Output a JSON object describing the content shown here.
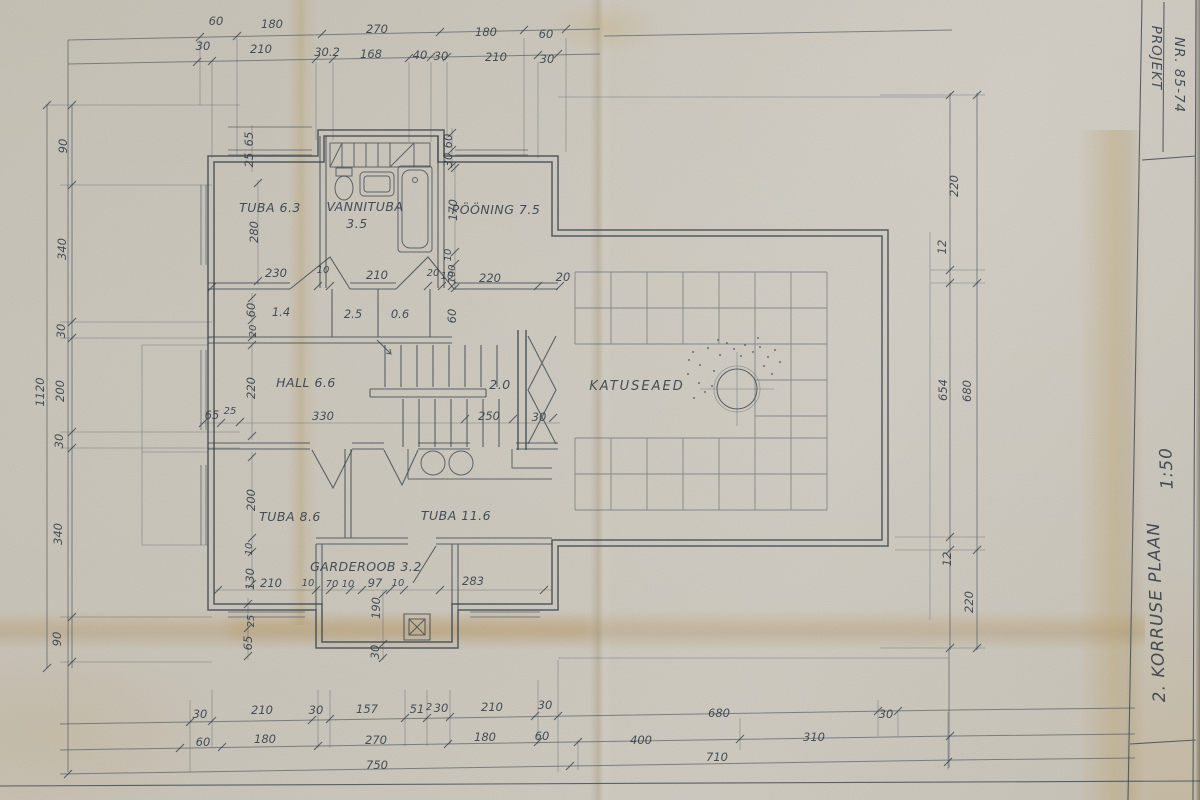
{
  "title_block": {
    "project_label": "PROJEKT",
    "project_number": "NR. 85-74",
    "plan_title": "2. KORRUSE  PLAAN",
    "scale": "1:50"
  },
  "rooms": {
    "tuba1": "TUBA  6.3",
    "vannituba_name": "VANNITUBA",
    "vannituba_area": "3.5",
    "pooning": "PÖÖNING 7.5",
    "hall": "HALL  6.6",
    "katuseaed": "KATUSEAED",
    "tuba2": "TUBA  8.6",
    "tuba3": "TUBA  11.6",
    "garderoob": "GARDEROOB 3.2",
    "stair_area": "2.0"
  },
  "dims": {
    "top1": [
      "60",
      "180",
      "270",
      "180",
      "60"
    ],
    "top2": [
      "30",
      "210",
      "30.2",
      "168",
      "40",
      "30",
      "210",
      "30"
    ],
    "left_outer": "1120",
    "left": [
      "90",
      "340",
      "30",
      "200",
      "30",
      "340",
      "90"
    ],
    "right": [
      "220",
      "12",
      "654",
      "12",
      "220"
    ],
    "right_outer": "680",
    "bottom1": [
      "30",
      "210",
      "30",
      "157",
      "51",
      "2",
      "30",
      "210",
      "30",
      "680",
      "30"
    ],
    "bottom2": [
      "60",
      "180",
      "270",
      "180",
      "60",
      "400",
      "310"
    ],
    "bottom3": [
      "750",
      "710"
    ],
    "interior": {
      "t65": "65",
      "t25": "25",
      "t280": "280",
      "t60": "60",
      "t30": "30",
      "t170": "170",
      "t10": "10",
      "t100": "100",
      "m230": "230",
      "m10a": "10",
      "m210": "210",
      "m20a": "20",
      "m10b": "10",
      "m220": "220",
      "m20b": "20",
      "c60a": "60",
      "c20": "20",
      "a14": "1.4",
      "a25": "2.5",
      "a06": "0.6",
      "c60b": "60",
      "h220": "220",
      "h65": "65",
      "h25": "25",
      "h330": "330",
      "h250": "250",
      "h30": "30",
      "b200": "200",
      "b10a": "10",
      "b130": "130",
      "b210": "210",
      "b10b": "10",
      "b7010": "70 10",
      "b97": "97",
      "b10c": "10",
      "b283": "283",
      "b190": "190",
      "b30": "30",
      "b25": "25",
      "b65": "65"
    }
  }
}
